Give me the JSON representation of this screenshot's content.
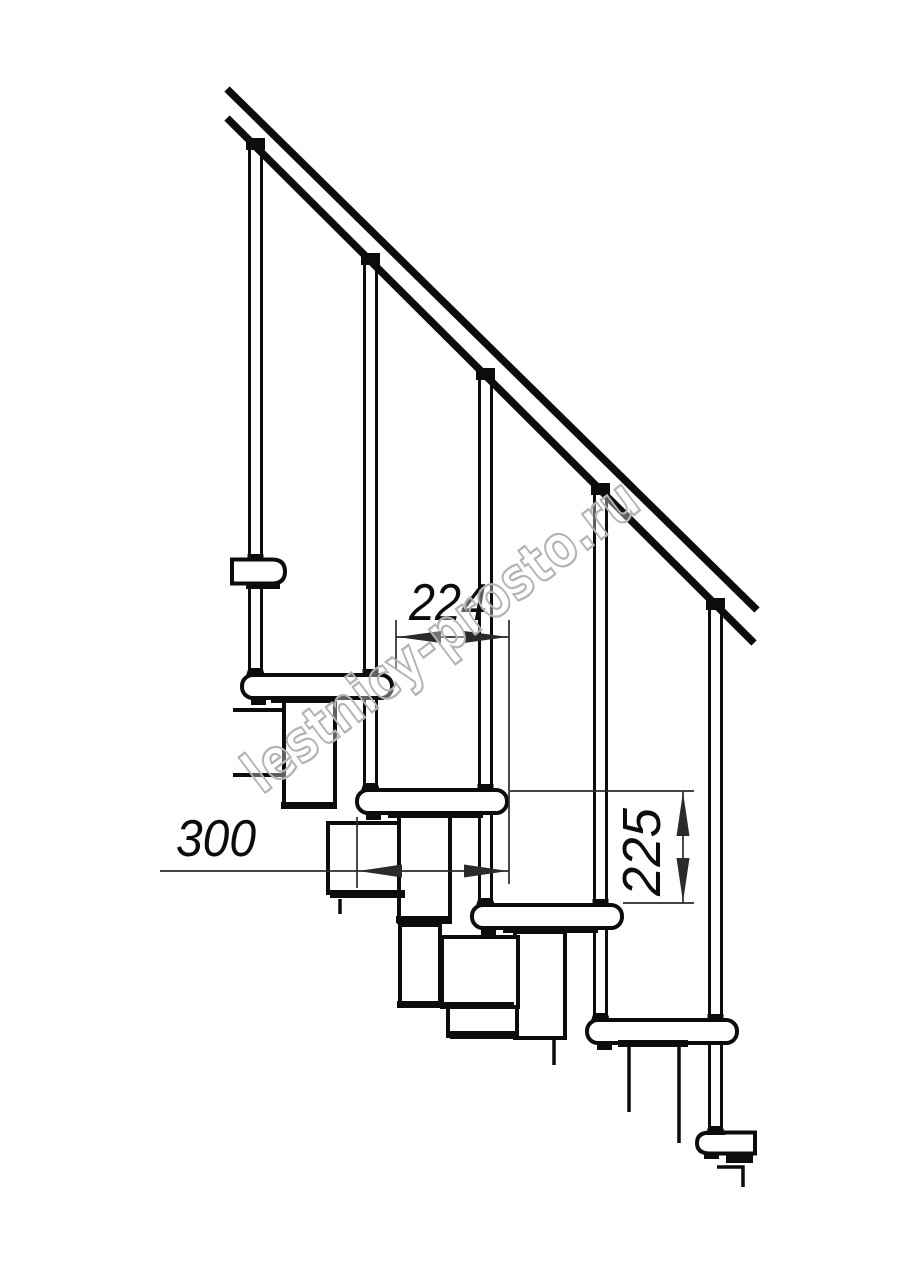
{
  "colors": {
    "line": "#0c0c0c",
    "thin": "#2b2b2b",
    "watermark_stroke": "#b3b3b3",
    "background": "#ffffff"
  },
  "watermark": {
    "text": "lestnicy-prosto.ru"
  },
  "dimensions": {
    "step_run": {
      "value": "224"
    },
    "tread_depth": {
      "value": "300"
    },
    "riser_height": {
      "value": "225"
    }
  },
  "drawing": {
    "type": "technical-line-drawing",
    "subject": "modular-staircase-side-view",
    "treads_visible": 6,
    "balusters_visible": 5
  }
}
